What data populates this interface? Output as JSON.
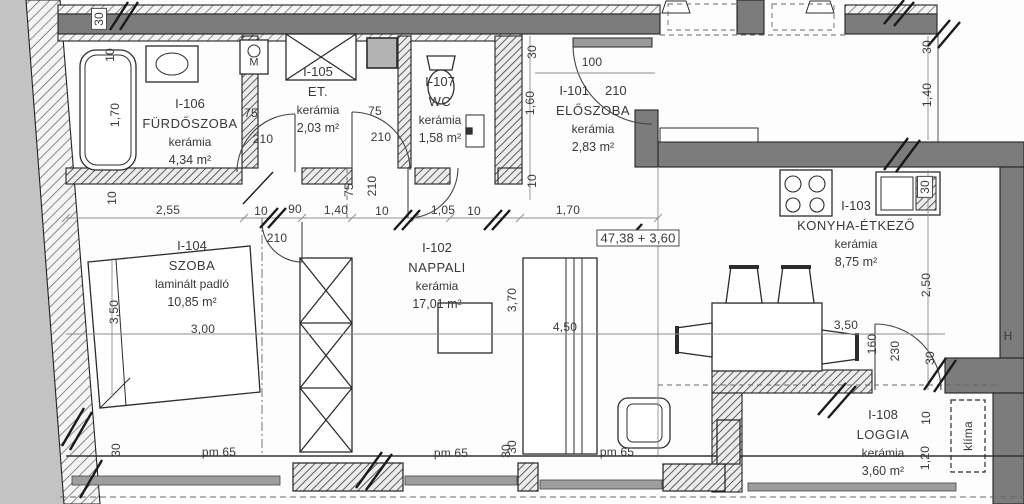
{
  "rooms": [
    {
      "id": "I-106",
      "name": "FÜRDŐSZOBA",
      "floor": "kerámia",
      "area": "4,34 m²"
    },
    {
      "id": "I-105",
      "name": "ET.",
      "floor": "kerámia",
      "area": "2,03 m²"
    },
    {
      "id": "I-107",
      "name": "WC",
      "floor": "kerámia",
      "area": "1,58 m²"
    },
    {
      "id": "I-101",
      "name": "ELŐSZOBA",
      "floor": "kerámia",
      "area": "2,83 m²"
    },
    {
      "id": "I-102",
      "name": "NAPPALI",
      "floor": "kerámia",
      "area": "17,01 m²"
    },
    {
      "id": "I-103",
      "name": "KONYHA-ÉTKEZŐ",
      "floor": "kerámia",
      "area": "8,75 m²"
    },
    {
      "id": "I-104",
      "name": "SZOBA",
      "floor": "laminált padló",
      "area": "10,85 m²"
    },
    {
      "id": "I-108",
      "name": "LOGGIA",
      "floor": "kerámia",
      "area": "3,60 m²"
    }
  ],
  "labels": {
    "total": "47,38 + 3,60",
    "klima": "klíma",
    "h": "H",
    "m": "M"
  },
  "dims": {
    "top30": "30",
    "b10a": "10",
    "b170": "1,70",
    "b10b": "10",
    "d255": "2,55",
    "d10a": "10",
    "d90": "90",
    "d140": "1,40",
    "d10b": "10",
    "d105": "1,05",
    "d10c": "10",
    "d170": "1,70",
    "bath75": "75",
    "bath210": "210",
    "et75": "75",
    "et210": "210",
    "corr75": "75",
    "corr210": "210",
    "d210b": "210",
    "elo100": "100",
    "elo210": "210",
    "elo30": "30",
    "elo160": "1,60",
    "elo10": "10",
    "r30a": "30",
    "r140": "1,40",
    "sink30": "30",
    "r250": "2,50",
    "nap370": "3,70",
    "nap450": "4,50",
    "nap30": "30",
    "din350": "3,50",
    "din160": "160",
    "din230": "230",
    "din30": "30",
    "sz350": "3,50",
    "sz300": "3,00",
    "log10": "10",
    "log120": "1,20",
    "pm65a": "pm 65",
    "pm65b": "pm 65",
    "pm65c": "pm 65",
    "bot30a": "30",
    "bot30b": "30"
  }
}
